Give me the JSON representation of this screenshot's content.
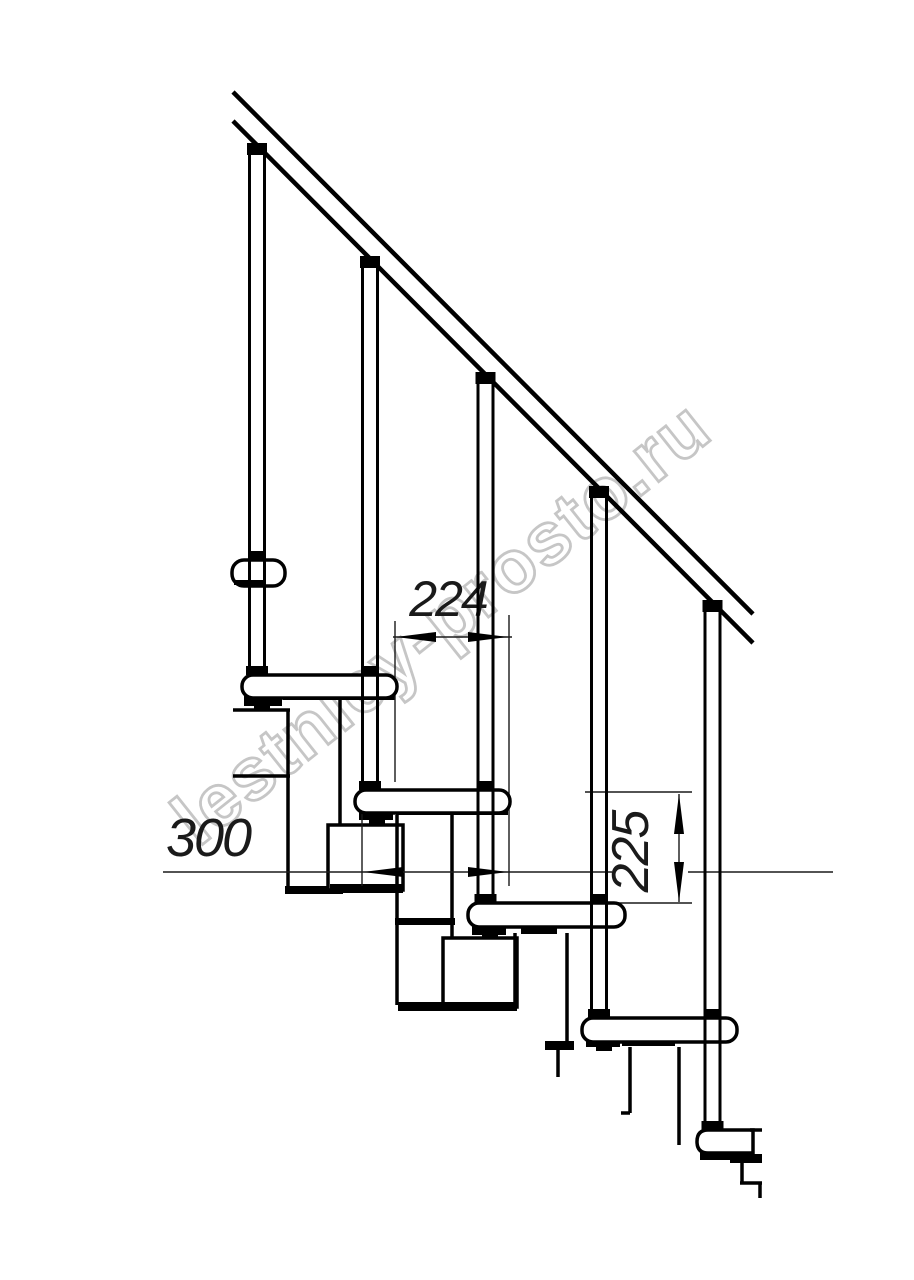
{
  "drawing": {
    "kind": "modular-staircase-side-view",
    "watermark_text": "lestnicy-prosto.ru",
    "dimensions": {
      "run_label": "224",
      "depth_label": "300",
      "rise_label": "225"
    },
    "counts": {
      "balusters": 5,
      "treads": 6
    },
    "colors": {
      "line": "#000000",
      "dimension": "#1a1a1a",
      "watermark": "#c6c6c6",
      "background": "#ffffff"
    }
  }
}
